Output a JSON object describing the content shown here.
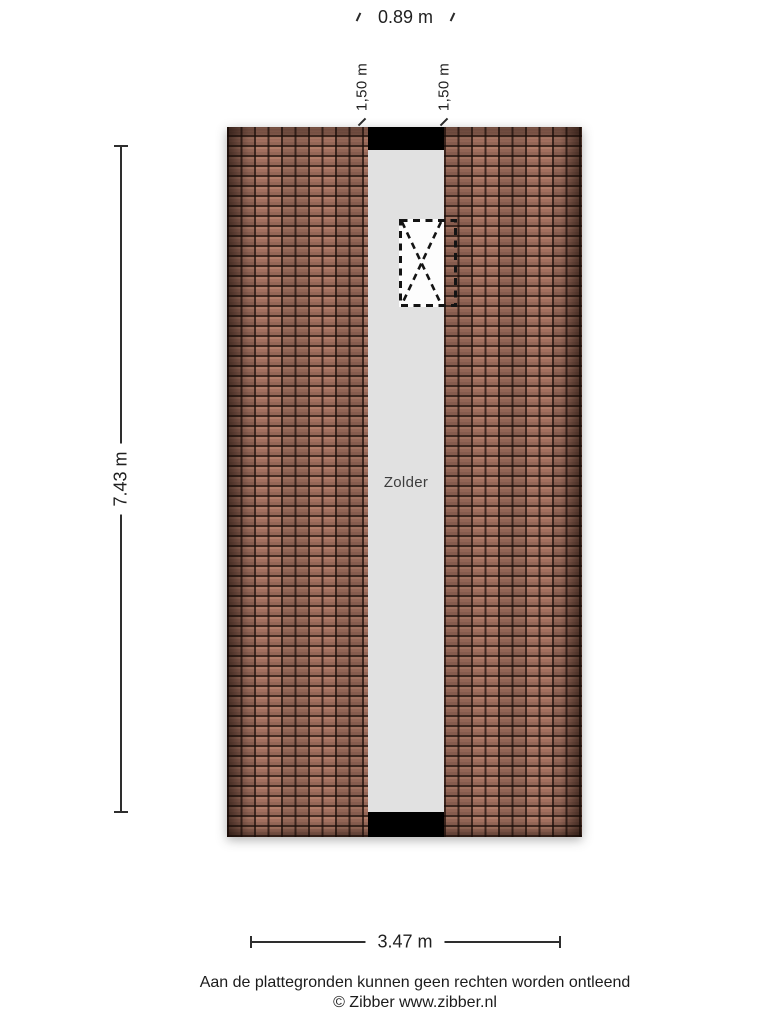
{
  "floorplan": {
    "room_label": "Zolder",
    "colors": {
      "roof_tile_base": "#9c6b59",
      "roof_tile_groove": "#452c23",
      "floor_gray": "#e1e1e1",
      "wall_bar_black": "#000000",
      "skylight_white": "#fdfdfd"
    }
  },
  "dimensions": {
    "corridor_width_top": "0.89 m",
    "dormer_left": "1,50 m",
    "dormer_right": "1,50 m",
    "plan_height_left": "7.43 m",
    "plan_width_bottom": "3.47 m"
  },
  "footer": {
    "disclaimer": "Aan de plattegronden kunnen geen rechten worden ontleend",
    "copyright": "© Zibber www.zibber.nl"
  }
}
